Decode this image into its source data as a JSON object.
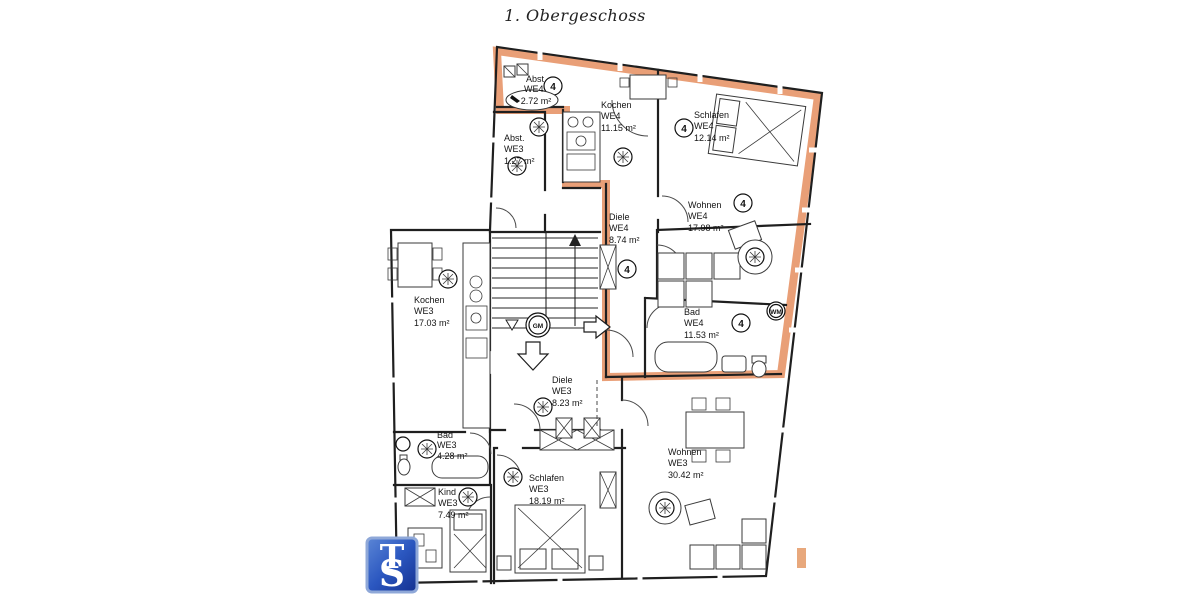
{
  "page": {
    "title": "1. Obergeschoss",
    "background": "#ffffff"
  },
  "plan": {
    "highlight_color": "#e89a70",
    "accent_color": "#e8a87c",
    "line_color": "#1f1f1f",
    "rooms": [
      {
        "name": "Abst.",
        "unit": "WE4",
        "area": "2.72 m²"
      },
      {
        "name": "Kochen",
        "unit": "WE4",
        "area": "11.15 m²"
      },
      {
        "name": "Schlafen",
        "unit": "WE4",
        "area": "12.14 m²"
      },
      {
        "name": "Wohnen",
        "unit": "WE4",
        "area": "17.98 m²"
      },
      {
        "name": "Diele",
        "unit": "WE4",
        "area": "8.74 m²"
      },
      {
        "name": "Bad",
        "unit": "WE4",
        "area": "11.53 m²"
      },
      {
        "name": "Abst.",
        "unit": "WE3",
        "area": "1.27 m²"
      },
      {
        "name": "Kochen",
        "unit": "WE3",
        "area": "17.03 m²"
      },
      {
        "name": "Diele",
        "unit": "WE3",
        "area": "8.23 m²"
      },
      {
        "name": "Bad",
        "unit": "WE3",
        "area": "4.28 m²"
      },
      {
        "name": "Kind",
        "unit": "WE3",
        "area": "7.49 m²"
      },
      {
        "name": "Schlafen",
        "unit": "WE3",
        "area": "18.19 m²"
      },
      {
        "name": "Wohnen",
        "unit": "WE3",
        "area": "30.42 m²"
      }
    ],
    "markers": {
      "unit4": "4",
      "gm": "GM",
      "wm": "WM"
    }
  },
  "logo": {
    "letter_t": "T",
    "letter_s": "S",
    "bg_color": "#2b57c0"
  }
}
